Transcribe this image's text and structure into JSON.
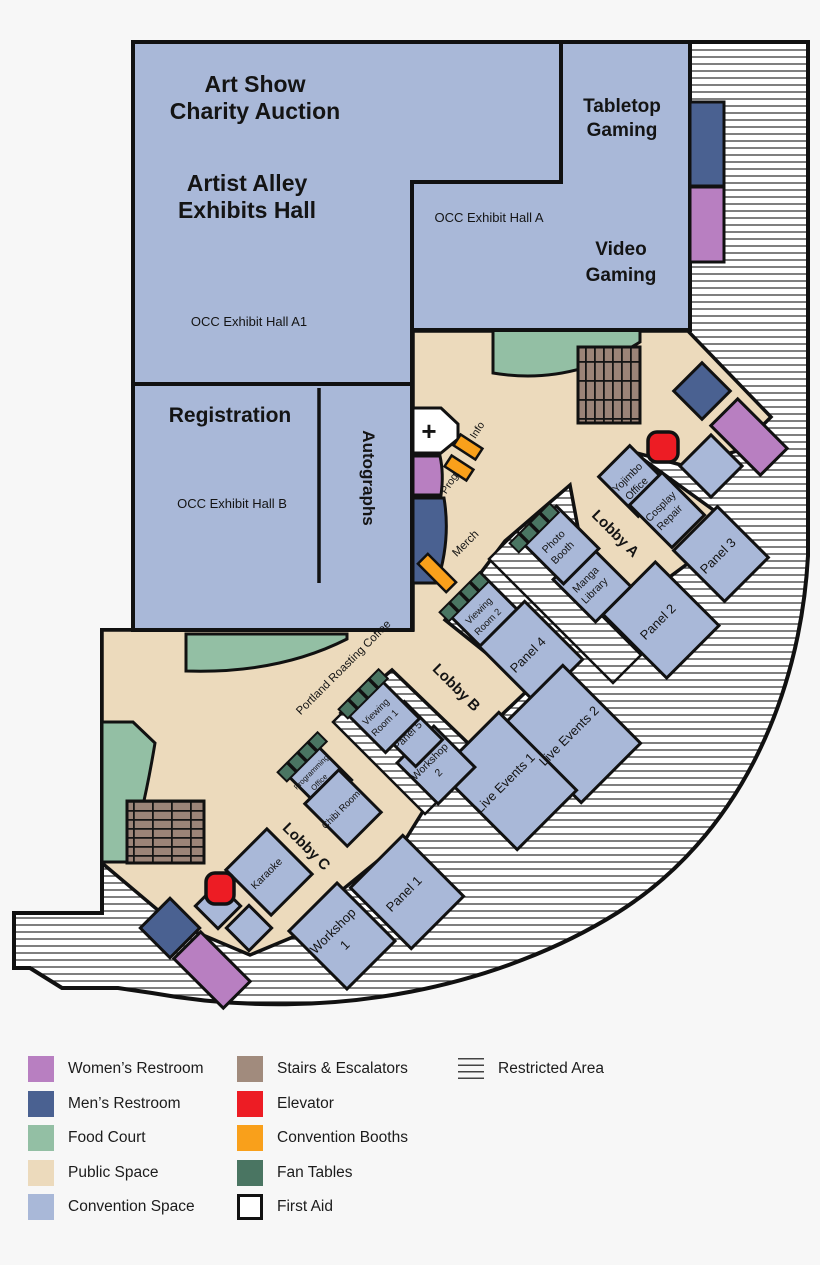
{
  "map": {
    "halls": {
      "hall_a1_line1": "Art Show",
      "hall_a1_line2": "Charity Auction",
      "hall_a1_line3": "Artist Alley",
      "hall_a1_line4": "Exhibits Hall",
      "hall_a1_name": "OCC Exhibit Hall A1",
      "hall_a_line1": "Tabletop",
      "hall_a_line2": "Gaming",
      "hall_a_name": "OCC Exhibit Hall A",
      "hall_a_line3": "Video",
      "hall_a_line4": "Gaming",
      "hall_b_title": "Registration",
      "hall_b_name": "OCC Exhibit Hall B",
      "autographs": "Autographs"
    },
    "corridors": {
      "lobby_a": "Lobby A",
      "lobby_b": "Lobby B",
      "lobby_c": "Lobby C",
      "coffee": "Portland Roasting Coffee",
      "merch": "Merch",
      "prog": "Prog.",
      "info": "Info",
      "first_aid_cross": "+"
    },
    "rooms": {
      "yojimbo1": "Yojimbo",
      "yojimbo2": "Office",
      "cosplay1": "Cosplay",
      "cosplay2": "Repair",
      "photo1": "Photo",
      "photo2": "Booth",
      "manga1": "Manga",
      "manga2": "Library",
      "viewing2a": "Viewing",
      "viewing2b": "Room 2",
      "viewing1a": "Viewing",
      "viewing1b": "Room 1",
      "panel1": "Panel 1",
      "panel2": "Panel 2",
      "panel3": "Panel 3",
      "panel4": "Panel 4",
      "panel5": "Panel 5",
      "workshop1a": "Workshop",
      "workshop1b": "1",
      "workshop2a": "Workshop",
      "workshop2b": "2",
      "live_events_1": "Live Events 1",
      "live_events_2": "Live Events 2",
      "prog_office1": "Programming",
      "prog_office2": "Office",
      "chibi": "Chibi Room",
      "karaoke": "Karaoke"
    }
  },
  "colors": {
    "womens_restroom": "#b87fc1",
    "mens_restroom": "#4a6191",
    "food_court": "#93bfa4",
    "public_space": "#ecdabc",
    "convention_space": "#a9b8d8",
    "stairs": "#9b8478",
    "elevator": "#ed1c24",
    "booths": "#f9a01b",
    "fan_tables": "#4a7562",
    "first_aid": "#ffffff",
    "wall": "#111111"
  },
  "legend": {
    "col1": [
      {
        "label": "Women’s Restroom",
        "color": "#b87fc1"
      },
      {
        "label": "Men’s Restroom",
        "color": "#4a6191"
      },
      {
        "label": "Food Court",
        "color": "#93bfa4"
      },
      {
        "label": "Public Space",
        "color": "#ecdabc"
      },
      {
        "label": "Convention Space",
        "color": "#a9b8d8"
      }
    ],
    "col2": [
      {
        "label": "Stairs & Escalators",
        "color": "#a18b7d"
      },
      {
        "label": "Elevator",
        "color": "#ed1c24"
      },
      {
        "label": "Convention Booths",
        "color": "#f9a01b"
      },
      {
        "label": "Fan Tables",
        "color": "#4a7562"
      },
      {
        "label": "First Aid",
        "color": "#ffffff"
      }
    ],
    "col3": [
      {
        "label": "Restricted Area"
      }
    ]
  }
}
